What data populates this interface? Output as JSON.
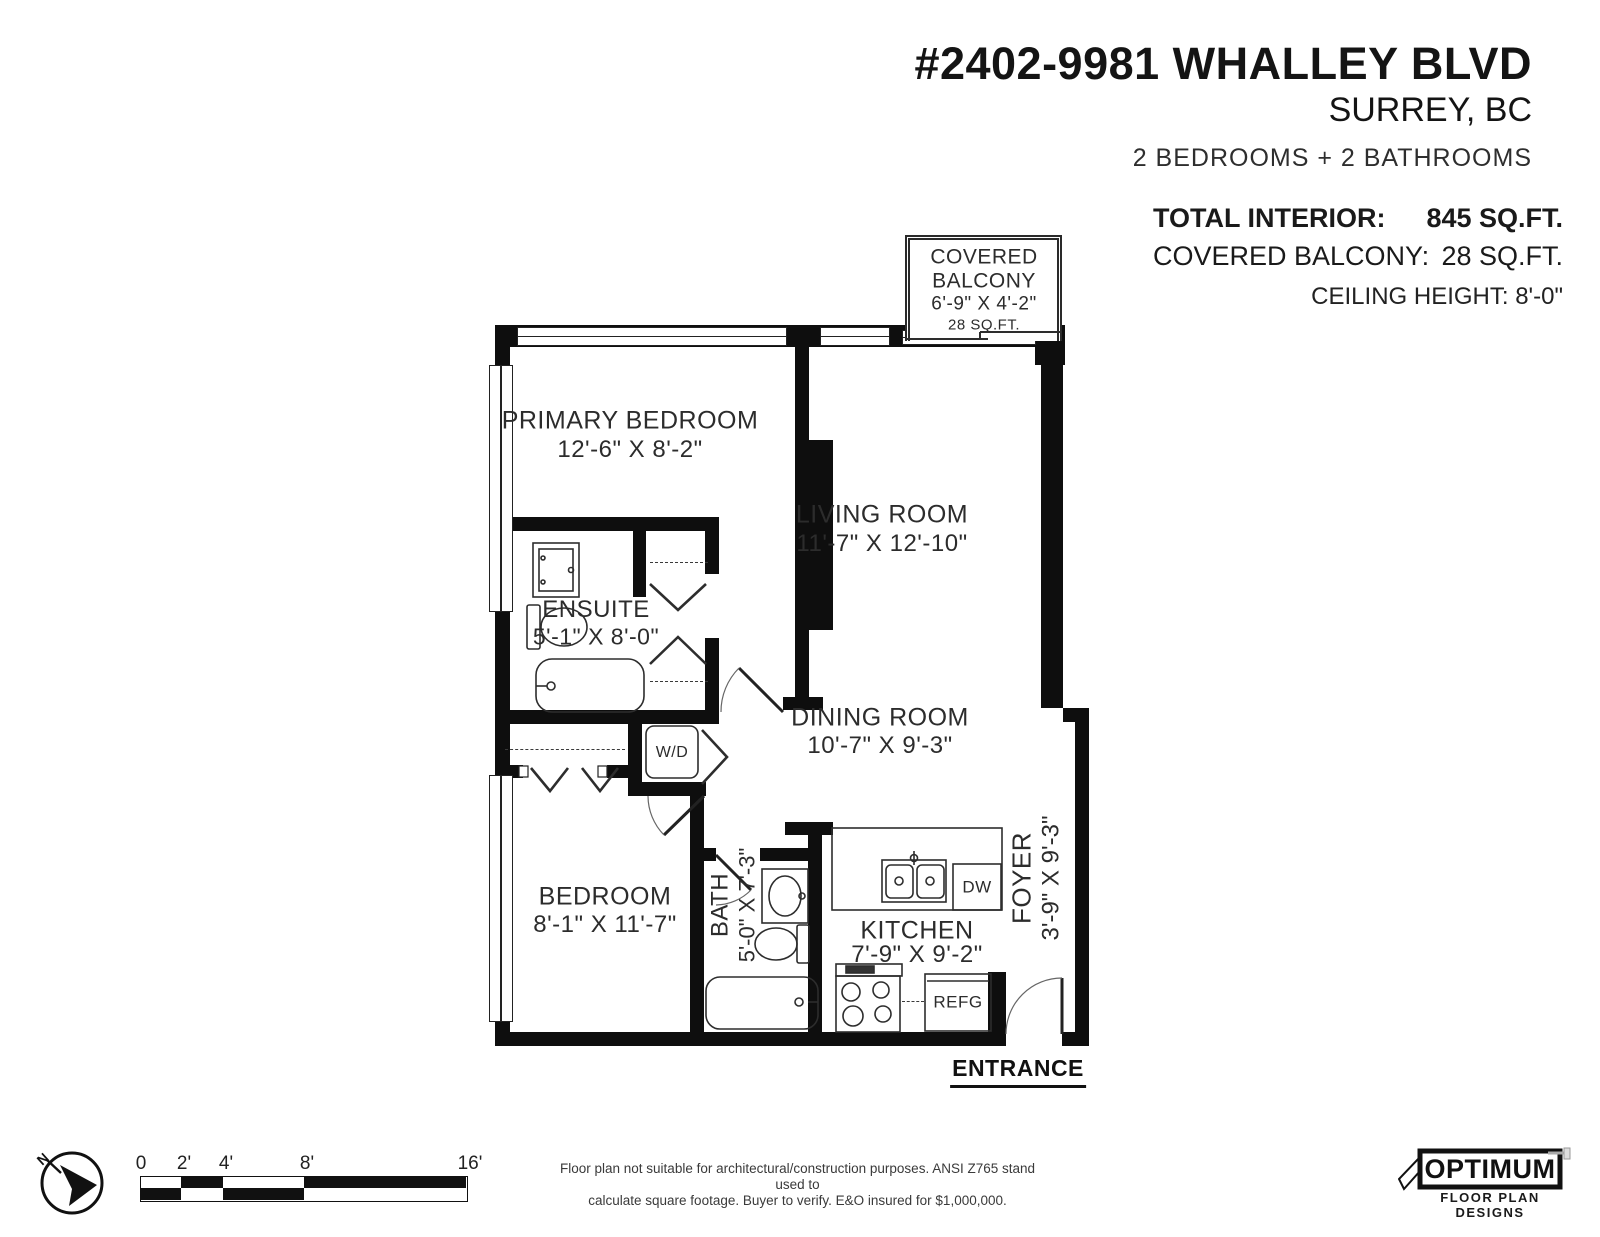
{
  "colors": {
    "wall": "#0e0e0e",
    "line": "#2d2d2d",
    "text": "#2c2c2c"
  },
  "header": {
    "address": "#2402-9981 WHALLEY BLVD",
    "city": "SURREY, BC",
    "summary": "2 BEDROOMS + 2 BATHROOMS",
    "total_interior_label": "TOTAL INTERIOR:",
    "total_interior_value": "845 SQ.FT.",
    "covered_balcony_label": "COVERED BALCONY:",
    "covered_balcony_value": "28 SQ.FT.",
    "ceiling": "CEILING HEIGHT: 8'-0\""
  },
  "rooms": {
    "balcony": {
      "line1": "COVERED",
      "line2": "BALCONY",
      "dims": "6'-9\" X 4'-2\"",
      "area": "28 SQ.FT."
    },
    "primary_bedroom": {
      "name": "PRIMARY BEDROOM",
      "dims": "12'-6\" X 8'-2\""
    },
    "living_room": {
      "name": "LIVING ROOM",
      "dims": "11'-7\" X 12'-10\""
    },
    "ensuite": {
      "name": "ENSUITE",
      "dims": "5'-1\" X 8'-0\""
    },
    "dining_room": {
      "name": "DINING ROOM",
      "dims": "10'-7\" X 9'-3\""
    },
    "bedroom": {
      "name": "BEDROOM",
      "dims": "8'-1\" X 11'-7\""
    },
    "bath": {
      "name": "BATH",
      "dims": "5'-0\" X 7'-3\""
    },
    "kitchen": {
      "name": "KITCHEN",
      "dims": "7'-9\" X 9'-2\""
    },
    "foyer": {
      "name": "FOYER",
      "dims": "3'-9\" X 9'-3\""
    },
    "washer_dryer": "W/D",
    "dishwasher": "DW",
    "fridge": "REFG"
  },
  "entrance_label": "ENTRANCE",
  "footer": {
    "compass_north": "N",
    "scale_labels": [
      "0",
      "2'",
      "4'",
      "8'",
      "16'"
    ],
    "disclaimer_line1": "Floor plan not suitable for architectural/construction purposes. ANSI Z765 stand used to",
    "disclaimer_line2": "calculate square footage. Buyer to verify.  E&O insured for $1,000,000.",
    "logo_name": "OPTIMUM",
    "logo_tagline": "FLOOR PLAN DESIGNS"
  }
}
